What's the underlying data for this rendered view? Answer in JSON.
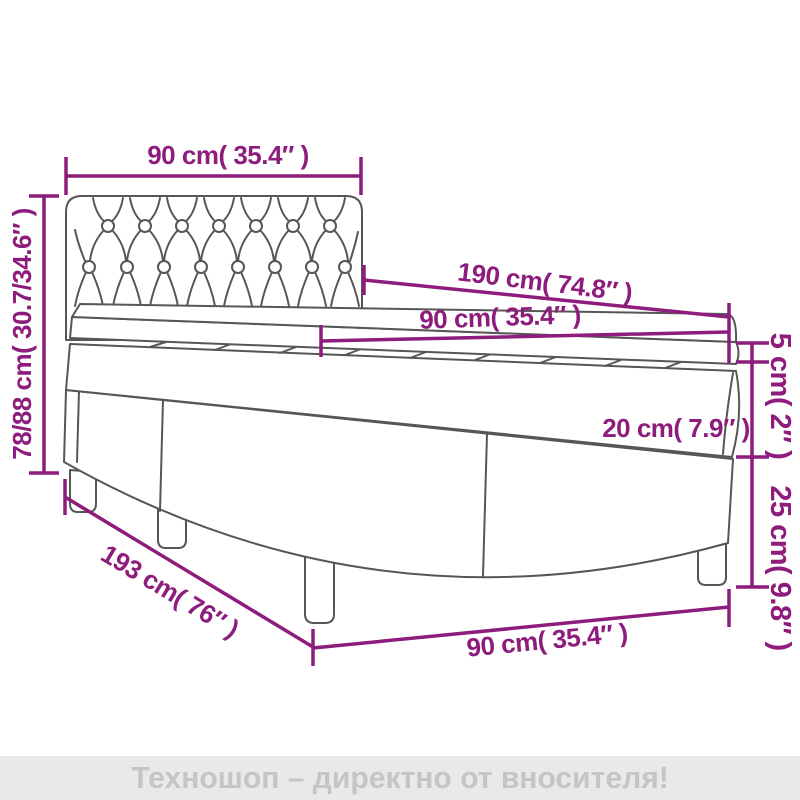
{
  "diagram": {
    "title": "box-spring-bed-dimension-diagram",
    "labels": {
      "headboard_width": "90 cm( 35.4″ )",
      "total_height": "78/88 cm( 30.7/34.6″ )",
      "bed_length": "190 cm( 74.8″ )",
      "mattress_width": "90 cm( 35.4″ )",
      "topper_thickness": "5 cm( 2″ )",
      "mattress_thickness": "20 cm( 7.9″ )",
      "base_height": "25 cm( 9.8″ )",
      "frame_length": "193 cm( 76″ )",
      "frame_width": "90 cm( 35.4″ )"
    },
    "colors": {
      "dimension_accent": "#8E1C7C",
      "drawing_outline": "#565656"
    }
  },
  "footer": {
    "text": "Техношоп – директно от вносителя!",
    "background": "#E9E9E9",
    "text_color": "#C5C5C5"
  }
}
